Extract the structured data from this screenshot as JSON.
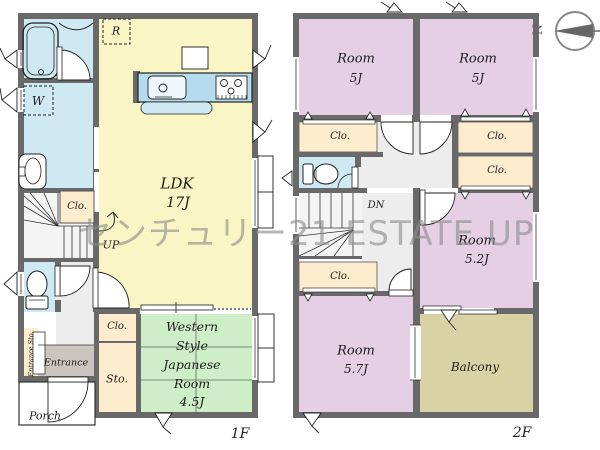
{
  "watermark": {
    "text": "センチュリー21 ESTATE UP",
    "color": "#8e8e8e"
  },
  "compass": {
    "north_label": "N"
  },
  "floor1": {
    "label": "1F",
    "ldk": {
      "name": "LDK",
      "size": "17J"
    },
    "japanese_room": {
      "line1": "Western",
      "line2": "Style",
      "line3": "Japanese",
      "line4": "Room",
      "size": "4.5J"
    },
    "refrigerator_label": "R",
    "washer_label": "W",
    "closet_label": "Clo.",
    "storage_label": "Sto.",
    "stairs_label": "UP",
    "entrance_label": "Entrance",
    "entrance_storage_label": "Entrance Sto.",
    "porch_label": "Porch"
  },
  "floor2": {
    "label": "2F",
    "room_nw": {
      "name": "Room",
      "size": "5J"
    },
    "room_ne": {
      "name": "Room",
      "size": "5J"
    },
    "room_e": {
      "name": "Room",
      "size": "5.2J"
    },
    "room_sw": {
      "name": "Room",
      "size": "5.7J"
    },
    "balcony_label": "Balcony",
    "closet_label": "Clo.",
    "stairs_label": "DN"
  },
  "colors": {
    "wall": "#696969",
    "ldk": "#f9f5c5",
    "wet_area": "#cfe9f3",
    "kitchen_counter": "#b5dcee",
    "tatami_room": "#cdeec6",
    "bedroom": "#e4cfe4",
    "closet": "#fdeccd",
    "balcony": "#d8d2a5",
    "hall": "#ededed",
    "entrance_floor": "#cac5bf",
    "watermark": "#8e8e8e"
  }
}
